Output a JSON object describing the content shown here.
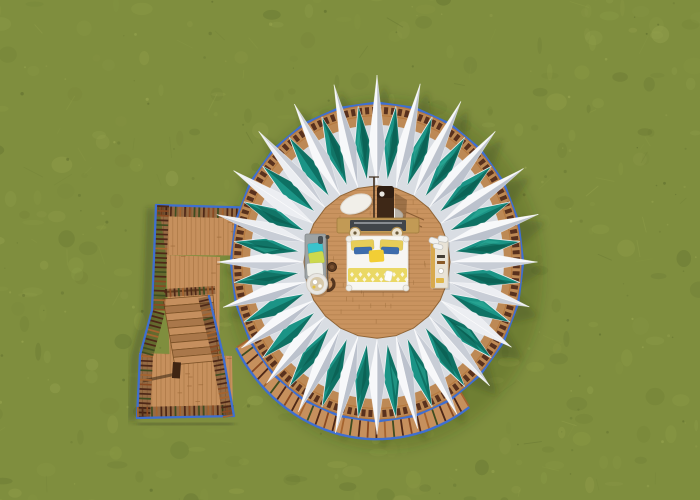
{
  "scene": {
    "description": "Aerial top-down 3D render of a circular lotus-style glamping tent with 24 white canopy spikes and teal fabric panels on a round wooden deck, furnished with a bed, bench, round table and cabinet, connected to a wooden walkway with stairs and blue-railed decking on mottled green grass",
    "canvas": {
      "width": 700,
      "height": 500
    },
    "colors": {
      "grass_base": "#7f8e3e",
      "grass_l": "#95a34c",
      "grass_l2": "#a3ae57",
      "grass_d": "#6b7a33",
      "grass_dd": "#55642a",
      "walk_wood": "#c6905d",
      "walk_line": "#9c6a3a",
      "deck_wood": "#bd8955",
      "deck_wood2": "#c9935f",
      "deck_line": "#a97845",
      "rim_blue": "#3f6fd0",
      "bal_dark": "#4e2817",
      "bal_wood": "#a5642f",
      "bal_wood2": "#8a4a22",
      "bal_green": "#3f4d20",
      "fabric_bright": "#f7f8fa",
      "fabric_light": "#eceef2",
      "fabric_mid": "#d9dde3",
      "fabric_shade": "#c8cdd6",
      "fabric_dark": "#bcc2cd",
      "teal": "#1b9486",
      "teal_dark": "#0c6b5e",
      "teal_deep": "#085548",
      "teal_light": "#2fae9a",
      "bed_white": "#f7f6f2",
      "yellow_pillow": "#e7cd58",
      "blue_pillow": "#3e6dac",
      "cushion": "#f2ce35",
      "band": "#ead864",
      "headboard": "#c29a55",
      "headboard_panel": "#41454a",
      "lamp": "#ece3cf",
      "bench": "#9da3a4",
      "towel_cyan": "#3ac3cd",
      "towel_lime": "#ccd94d",
      "towel_white": "#edefe9",
      "stove": "#3e2817",
      "chair": "#55361f",
      "cabinet": "#e9e3d6",
      "cabinet_side": "#d8a94e",
      "rug": "#f1efe9"
    },
    "grass": {
      "seed": 7,
      "blobs": 340,
      "dots": 170,
      "streaks": 70
    },
    "tent": {
      "cx": 377,
      "cy": 262,
      "points": 24,
      "r_tip_upper": 167,
      "r_tip_lower": 158,
      "r_rim": 146,
      "r_baluster": 139.5,
      "r_fabric": 127,
      "r_teal_outer": 144,
      "r_teal_waist": 111,
      "teal_half_deg": 4.1,
      "r_teal_inner": 79,
      "spike_half_deg": 4.2,
      "r_spike_waist": 110,
      "r_spike_inner": 74,
      "r_deck": 73,
      "skirt": {
        "a0": 55,
        "a1": 152,
        "r0": 145,
        "r1": 161
      }
    },
    "walkway": {
      "platform": [
        [
          159,
          206
        ],
        [
          296,
          210
        ],
        [
          298,
          256
        ],
        [
          166,
          255
        ]
      ],
      "stairwell": [
        [
          166,
          255
        ],
        [
          220,
          257
        ],
        [
          219,
          366
        ],
        [
          170,
          368
        ]
      ],
      "landing": [
        [
          139,
          353
        ],
        [
          232,
          356
        ],
        [
          233,
          416
        ],
        [
          138,
          417
        ]
      ],
      "treads": {
        "count": 9,
        "left": [
          163,
          299
        ],
        "right": [
          213,
          295
        ],
        "step_dy": 7.3,
        "left_dx": 1.3,
        "right_dx": 0.6,
        "depth": 7.3
      },
      "gate": [
        [
          165,
          289
        ],
        [
          215,
          286
        ]
      ],
      "newel": {
        "x": 173,
        "y": 362,
        "w": 8,
        "h": 16
      },
      "newel_shadow": [
        [
          176,
          374
        ],
        [
          143,
          381
        ]
      ],
      "rails": {
        "top": {
          "pts": [
            [
              156,
              205
            ],
            [
              297,
              209
            ]
          ],
          "inward": [
            0,
            1
          ],
          "len": 11
        },
        "left": {
          "pts": [
            [
              156,
              205
            ],
            [
              152,
              310
            ],
            [
              140,
              355
            ],
            [
              137,
              418
            ]
          ],
          "inward": [
            1,
            0
          ],
          "len": 13
        },
        "bottom": {
          "pts": [
            [
              137,
              418
            ],
            [
              234,
              416
            ]
          ],
          "inward": [
            0,
            -1
          ],
          "len": 11
        },
        "right": {
          "pts": [
            [
              234,
              416
            ],
            [
              223,
              355
            ],
            [
              209,
              296
            ]
          ],
          "inward": [
            -1,
            0
          ],
          "len": 11
        }
      }
    },
    "furniture": {
      "rugs": [
        {
          "cx": 356,
          "cy": 204,
          "rx": 16,
          "ry": 9,
          "rot": -20
        },
        {
          "cx": 392,
          "cy": 214,
          "rx": 11,
          "ry": 6,
          "rot": 12
        }
      ],
      "stove": {
        "x": 377,
        "y": 186,
        "w": 17,
        "h": 41,
        "cap": {
          "cx": 382,
          "cy": 194,
          "r": 2.6
        },
        "chimney": [
          [
            374,
            177
          ],
          [
            374,
            229
          ]
        ],
        "shadow": [
          [
            395,
            193
          ],
          [
            407,
            200
          ],
          [
            405,
            232
          ],
          [
            395,
            228
          ]
        ]
      },
      "headboard": {
        "x": 337,
        "y": 218,
        "w": 82,
        "h": 15,
        "panel": {
          "x": 350,
          "y": 220,
          "w": 56,
          "h": 11
        },
        "lamps": [
          [
            355,
            233
          ],
          [
            397,
            233
          ]
        ]
      },
      "bed": {
        "x": 347,
        "y": 236,
        "w": 61,
        "h": 54,
        "pillows": [
          {
            "x": 351,
            "y": 240,
            "w": 23,
            "h": 10,
            "rot": -3,
            "c": "yellow_pillow"
          },
          {
            "x": 380,
            "y": 240,
            "w": 23,
            "h": 10,
            "rot": 3,
            "c": "yellow_pillow"
          },
          {
            "x": 354,
            "y": 247,
            "w": 18,
            "h": 7,
            "rot": -2,
            "c": "blue_pillow"
          },
          {
            "x": 381,
            "y": 247,
            "w": 18,
            "h": 7,
            "rot": 2,
            "c": "blue_pillow"
          }
        ],
        "cushion": {
          "x": 369,
          "y": 250,
          "w": 15,
          "h": 12,
          "rot": -4
        },
        "band": {
          "x": 348,
          "y": 268,
          "w": 59,
          "h": 14
        },
        "towel": {
          "x": 385,
          "y": 271,
          "w": 7,
          "h": 10,
          "rot": 12
        },
        "knobs": [
          [
            349,
            239
          ],
          [
            406,
            239
          ],
          [
            349,
            288
          ],
          [
            406,
            288
          ]
        ]
      },
      "bench": {
        "x": 305,
        "y": 234,
        "w": 21,
        "h": 45,
        "rail": [
          [
            327,
            235
          ],
          [
            328,
            290
          ]
        ],
        "items": [
          {
            "x": 308,
            "y": 243,
            "w": 15,
            "h": 12,
            "rot": -6,
            "c": "towel_cyan"
          },
          {
            "x": 309,
            "y": 252,
            "w": 15,
            "h": 12,
            "rot": -10,
            "c": "towel_lime"
          },
          {
            "x": 307,
            "y": 263,
            "w": 16,
            "h": 13,
            "rot": -4,
            "c": "towel_white"
          }
        ],
        "strap": {
          "x": 318,
          "y": 236,
          "w": 5,
          "h": 8
        }
      },
      "stool": {
        "cx": 332,
        "cy": 267,
        "r": 4.5
      },
      "table": {
        "cx": 317,
        "cy": 284,
        "r": 10.5,
        "tray_r": 7,
        "chair": {
          "cx": 327.5,
          "cy": 284,
          "r": 6.5
        }
      },
      "cabinet": {
        "x": 431,
        "y": 240,
        "w": 17,
        "h": 48,
        "side_w": 4,
        "shoes": [
          {
            "x": 429,
            "y": 238,
            "w": 10,
            "h": 6,
            "rot": 18
          },
          {
            "x": 438,
            "y": 236,
            "w": 10,
            "h": 6,
            "rot": 8
          },
          {
            "x": 433,
            "y": 244,
            "w": 10,
            "h": 5,
            "rot": 14
          }
        ],
        "drawers": [
          {
            "x": 437,
            "y": 255,
            "w": 8,
            "h": 3,
            "c": "#433d34"
          },
          {
            "x": 437,
            "y": 261,
            "w": 8,
            "h": 3,
            "c": "#8a5a28"
          }
        ],
        "knob": {
          "cx": 441,
          "cy": 271,
          "r": 2.6
        },
        "basket": {
          "x": 436,
          "y": 278,
          "w": 8,
          "h": 5
        }
      },
      "deck_steps": [
        [
          [
            406,
            212
          ],
          [
            424,
            220
          ]
        ],
        [
          [
            404,
            219
          ],
          [
            422,
            227
          ]
        ]
      ]
    }
  }
}
